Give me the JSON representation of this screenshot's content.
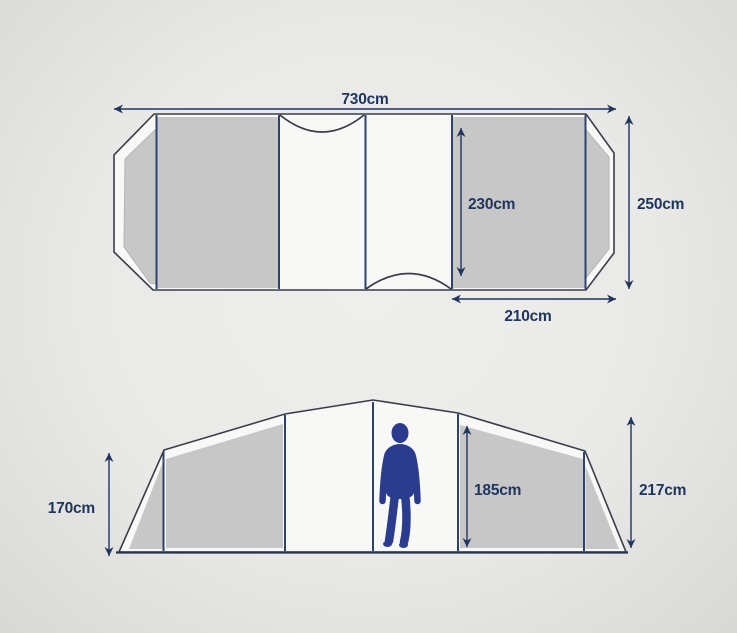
{
  "diagram": {
    "title": "tent-dimensions",
    "floor_plan": {
      "total_length_label": "730cm",
      "total_width_label": "250cm",
      "inner_width_label": "230cm",
      "bedroom_length_label": "210cm"
    },
    "side_elevation": {
      "side_wall_height_label": "170cm",
      "inner_height_label": "185cm",
      "peak_height_label": "217cm"
    },
    "colors": {
      "background": "#e9e9e7",
      "tent_fill": "#f8f8f6",
      "panel_gray": "#c7c7c8",
      "outline_dark": "#383d4a",
      "divider_navy": "#30406f",
      "dimension_navy": "#1e355e",
      "figure_blue": "#2b3c8e"
    }
  }
}
